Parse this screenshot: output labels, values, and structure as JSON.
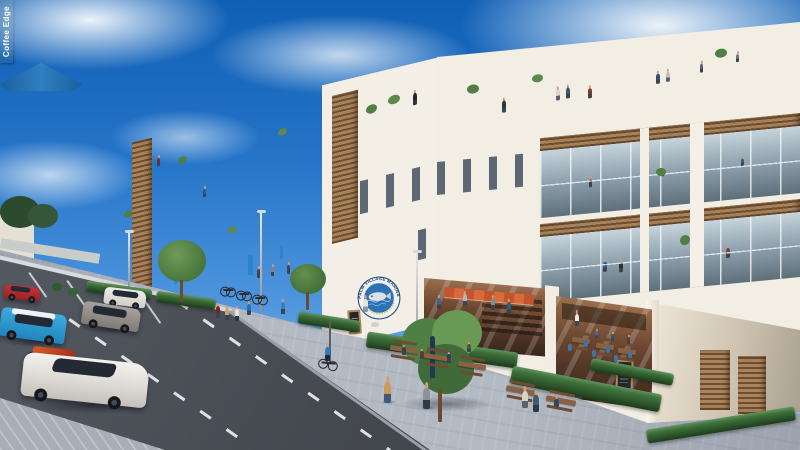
{
  "signs": {
    "coffee_shop_vertical": "Coffee Edge",
    "marina_badge_arc": "PALM VILLAGE MARINA"
  },
  "scene": {
    "setting": "sunny daytime 3D architectural rendering, blue sky with wispy clouds",
    "building": "white 4-storey mixed-use block: ground-floor shops and cafe-restaurant, balcony apartments above, glass office floors and rooftop terrace with people",
    "street": "asphalt road with dashed lane markings and parked vehicles, paved pedestrian plaza with hedged cafe terrace, trees, cyclists and pedestrians"
  },
  "vehicles": [
    {
      "type": "car",
      "color": "#b3262c"
    },
    {
      "type": "van",
      "color": "#e7e5e0"
    },
    {
      "type": "suv",
      "color": "#98938c"
    },
    {
      "type": "compact-car",
      "color": "#2f9fd8"
    },
    {
      "type": "motorcycle",
      "color": "#c7482a"
    },
    {
      "type": "hatchback",
      "color": "#eceae6"
    }
  ],
  "palette": {
    "sky_top": "#0f5fb5",
    "sky_horizon": "#8fc0ec",
    "facade_white": "#f3eee4",
    "wood_accent": "#a8835c",
    "glass_blue": "#8da0ac",
    "sign_blue": "#1f66ad",
    "hedge_green": "#2b5428",
    "road_asphalt": "#4b4f56",
    "plaza_paving": "#b4bac3",
    "umbrella_blue": "#2f7fc2"
  }
}
